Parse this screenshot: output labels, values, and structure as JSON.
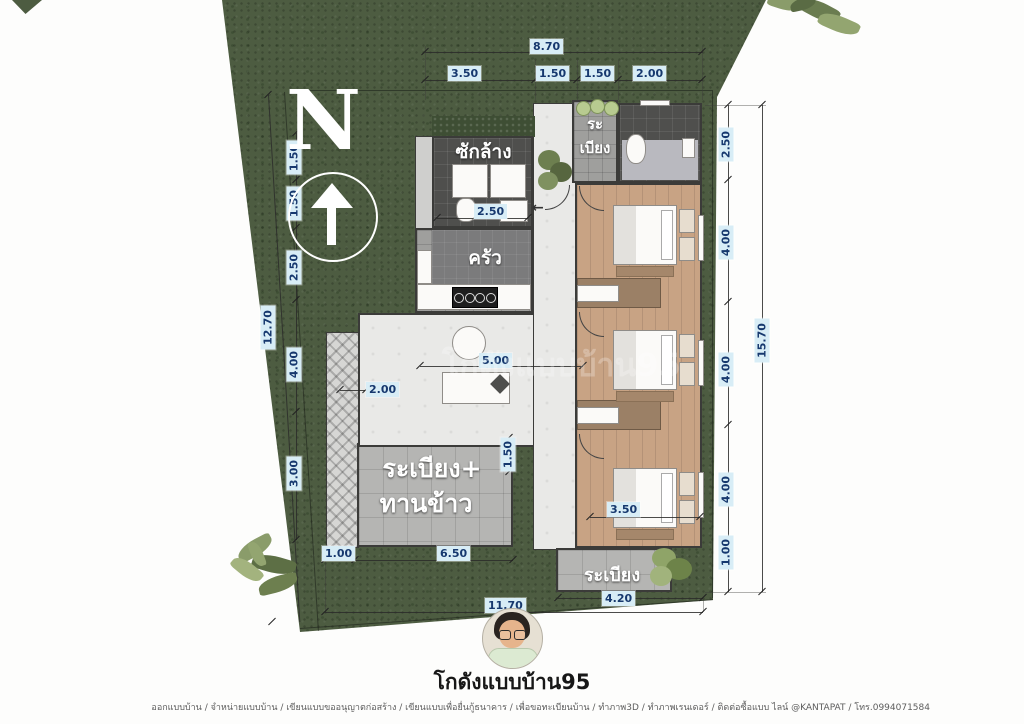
{
  "title": "โกดังแบบบ้าน95",
  "watermark": "โกดังแบบบ้าน95",
  "north": {
    "label": "N"
  },
  "rooms": {
    "laundry": "ซักล้าง",
    "balcony_top": [
      "ระ",
      "เบียง"
    ],
    "kitchen": "ครัว",
    "terrace": [
      "ระเบียง+",
      "ทานข้าว"
    ],
    "balcony_bottom": "ระเบียง"
  },
  "dims": {
    "top_total": "8.70",
    "top": [
      "3.50",
      "1.50",
      "1.50",
      "2.00"
    ],
    "left_total": "12.70",
    "left": [
      "1.50",
      "1.50",
      "2.50",
      "4.00",
      "3.00"
    ],
    "right_total": "15.70",
    "right": [
      "2.50",
      "4.00",
      "4.00",
      "4.00",
      "1.00"
    ],
    "bottom_total": "11.70",
    "bottom_left": [
      "1.00",
      "6.50"
    ],
    "bottom_right": "4.20",
    "laundry_width": "2.50",
    "living_width": "5.00",
    "walkway_offset": "2.00",
    "terrace_step": "1.50",
    "bedroom_width": "3.50"
  },
  "footer_text": "ออกแบบบ้าน / จำหน่ายแบบบ้าน / เขียนแบบขออนุญาตก่อสร้าง / เขียนแบบเพื่อยื่นกู้ธนาคาร / เพื่อขอทะเบียนบ้าน / ทำภาพ3D / ทำภาพเรนเดอร์ / ติดต่อซื้อแบบ ไลน์ @KANTAPAT / โทร.0994071584",
  "colors": {
    "grass": "#4d5c41",
    "dim_label_bg": "#d8edf6",
    "dim_label_text": "#16386e",
    "wood_floor": "#c8a384",
    "wall": "#3b3b39"
  }
}
